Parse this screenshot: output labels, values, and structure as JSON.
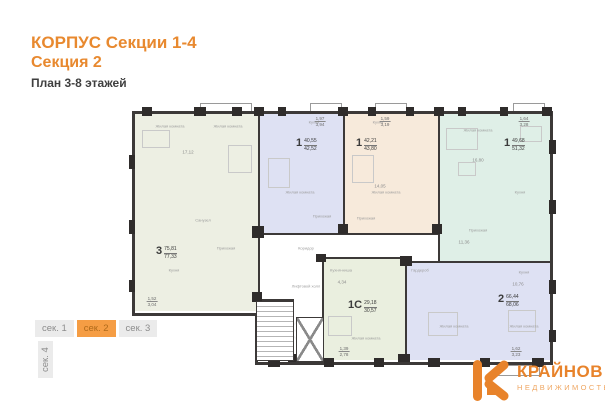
{
  "header": {
    "title_line1": "КОРПУС Секции 1-4",
    "title_line2": "Секция 2",
    "subtitle": "План 3-8 этажей"
  },
  "section_tabs": {
    "items": [
      {
        "label": "сек. 1",
        "active": false
      },
      {
        "label": "сек. 2",
        "active": true
      },
      {
        "label": "сек. 3",
        "active": false
      },
      {
        "label": "сек. 4",
        "active": false
      }
    ]
  },
  "logo": {
    "brand": "КРАЙНОВ",
    "tagline": "НЕДВИЖИМОСТЬ"
  },
  "colors": {
    "accent_orange": "#E8892F",
    "tab_active_bg": "#F59D44",
    "wall": "#3C3938",
    "apt_sage": "#EDEFE3",
    "apt_lavender": "#DEE1F3",
    "apt_beige": "#F7EADB",
    "apt_mint": "#DFEFE7",
    "apt_studio": "#EAEFDF",
    "room_label_gray": "#9B9B9B"
  },
  "plan": {
    "apartments": [
      {
        "id": "apt-3-rooms",
        "num": "3",
        "area_living": "75,81",
        "area_total": "77,33",
        "color": "#EDEFE3",
        "x": 7,
        "y": 14,
        "w": 123,
        "h": 197,
        "label_x": 28,
        "label_y": 146
      },
      {
        "id": "apt-1-lavender",
        "num": "1",
        "area_living": "40,55",
        "area_total": "42,52",
        "color": "#DEE1F3",
        "x": 132,
        "y": 14,
        "w": 83,
        "h": 119,
        "label_x": 168,
        "label_y": 38
      },
      {
        "id": "apt-1-beige",
        "num": "1",
        "area_living": "42,21",
        "area_total": "43,80",
        "color": "#F7EADB",
        "x": 217,
        "y": 14,
        "w": 93,
        "h": 119,
        "label_x": 228,
        "label_y": 38
      },
      {
        "id": "apt-1-mint",
        "num": "1",
        "area_living": "49,68",
        "area_total": "51,32",
        "color": "#DFEFE7",
        "x": 312,
        "y": 14,
        "w": 110,
        "h": 147,
        "label_x": 376,
        "label_y": 38
      },
      {
        "id": "apt-1c-studio",
        "num": "1С",
        "area_living": "29,18",
        "area_total": "30,57",
        "color": "#EAEFDF",
        "x": 196,
        "y": 159,
        "w": 81,
        "h": 101,
        "label_x": 220,
        "label_y": 200
      },
      {
        "id": "apt-2-lavender",
        "num": "2",
        "area_living": "66,44",
        "area_total": "68,06",
        "color": "#DEE1F3",
        "x": 279,
        "y": 163,
        "w": 143,
        "h": 97,
        "label_x": 370,
        "label_y": 194
      }
    ],
    "rooms": [
      {
        "label": "Жилая комната",
        "x": 42,
        "y": 26
      },
      {
        "label": "Жилая комната",
        "x": 100,
        "y": 26
      },
      {
        "label": "Кухня",
        "x": 46,
        "y": 170
      },
      {
        "label": "Санузел",
        "x": 75,
        "y": 120
      },
      {
        "label": "Прихожая",
        "x": 98,
        "y": 148
      },
      {
        "label": "Кухня",
        "x": 186,
        "y": 22
      },
      {
        "label": "Жилая комната",
        "x": 172,
        "y": 92
      },
      {
        "label": "Прихожая",
        "x": 194,
        "y": 116
      },
      {
        "label": "Кухня",
        "x": 250,
        "y": 22
      },
      {
        "label": "Жилая комната",
        "x": 258,
        "y": 92
      },
      {
        "label": "Прихожая",
        "x": 238,
        "y": 118
      },
      {
        "label": "Жилая комната",
        "x": 350,
        "y": 30
      },
      {
        "label": "Кухня",
        "x": 392,
        "y": 92
      },
      {
        "label": "Прихожая",
        "x": 350,
        "y": 130
      },
      {
        "label": "Кухня-ниша",
        "x": 213,
        "y": 170
      },
      {
        "label": "Жилая комната",
        "x": 238,
        "y": 238
      },
      {
        "label": "Гардероб",
        "x": 292,
        "y": 170
      },
      {
        "label": "Кухня",
        "x": 396,
        "y": 172
      },
      {
        "label": "Жилая комната",
        "x": 326,
        "y": 226
      },
      {
        "label": "Жилая комната",
        "x": 396,
        "y": 226
      },
      {
        "label": "Лифтовой холл",
        "x": 178,
        "y": 186
      },
      {
        "label": "Коридор",
        "x": 178,
        "y": 148
      }
    ],
    "dims": [
      {
        "value": "17,12",
        "x": 60,
        "y": 52
      },
      {
        "value": "14,05",
        "x": 252,
        "y": 86
      },
      {
        "value": "16,80",
        "x": 350,
        "y": 60
      },
      {
        "value": "11,36",
        "x": 336,
        "y": 142
      },
      {
        "value": "10,76",
        "x": 390,
        "y": 184
      },
      {
        "value": "4,34",
        "x": 214,
        "y": 182
      }
    ],
    "area_fractions": [
      {
        "top": "1,97",
        "bottom": "3,94",
        "x": 192,
        "y": 16
      },
      {
        "top": "1,59",
        "bottom": "3,19",
        "x": 257,
        "y": 16
      },
      {
        "top": "1,64",
        "bottom": "3,28",
        "x": 396,
        "y": 16
      },
      {
        "top": "1,62",
        "bottom": "3,23",
        "x": 388,
        "y": 246
      },
      {
        "top": "1,39",
        "bottom": "2,78",
        "x": 216,
        "y": 246
      },
      {
        "top": "1,52",
        "bottom": "3,04",
        "x": 24,
        "y": 196
      }
    ]
  }
}
